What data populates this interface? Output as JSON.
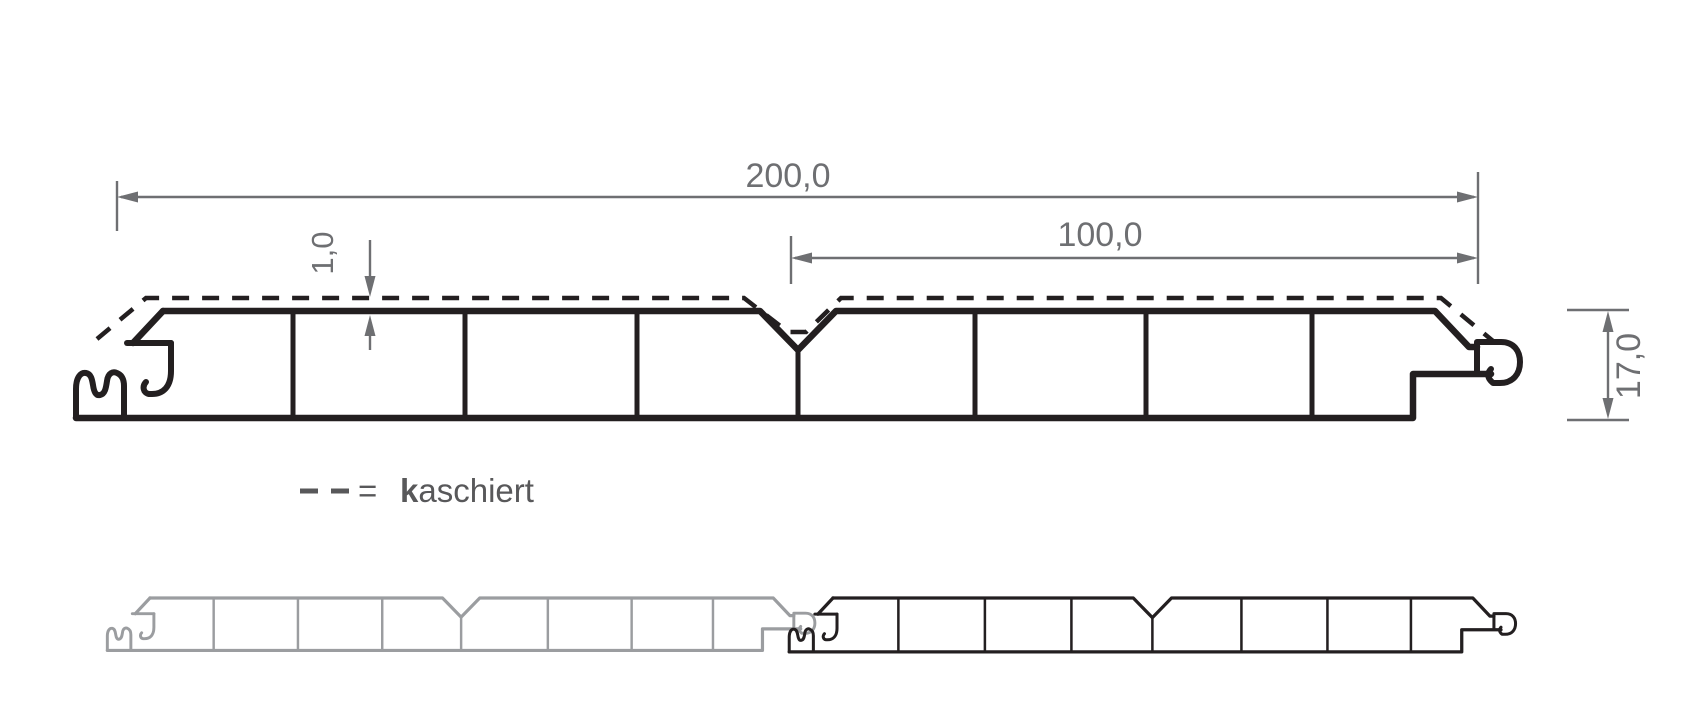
{
  "dimensions": {
    "total_width": "200,0",
    "half_width": "100,0",
    "lamination_thickness": "1,0",
    "panel_thickness": "17,0"
  },
  "legend": {
    "equals": "=",
    "label_bold": "k",
    "label_rest": "aschiert"
  },
  "colors": {
    "line": "#231f20",
    "dimension": "#6e6f72",
    "gray_panel": "#9b9da0",
    "legend_text": "#58585a",
    "background": "#ffffff"
  }
}
